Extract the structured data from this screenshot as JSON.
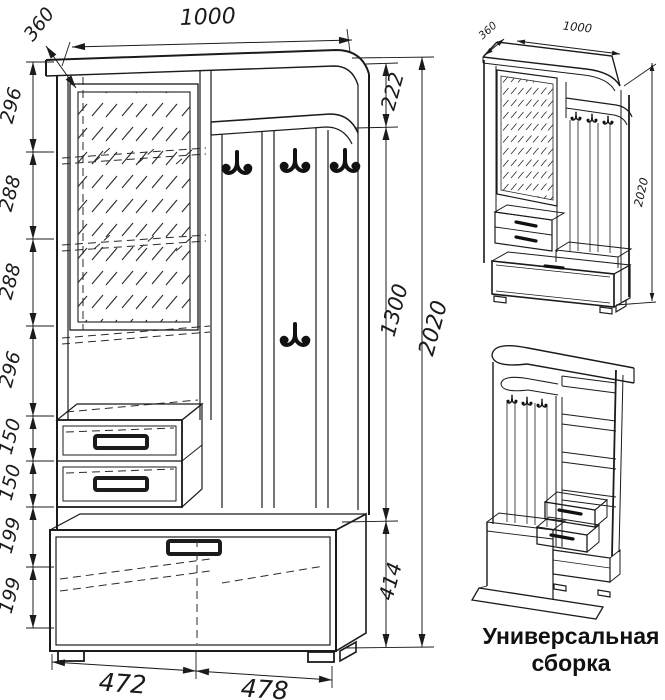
{
  "main_view": {
    "top_width": "1000",
    "depth": "360",
    "left_chain": [
      "296",
      "288",
      "288",
      "296",
      "150",
      "150",
      "199",
      "199"
    ],
    "right_chain": {
      "niche": "222",
      "hooks": "1300",
      "cabinet": "414",
      "total": "2020"
    },
    "bottom_chain": [
      "472",
      "478"
    ]
  },
  "iso_view": {
    "depth": "360",
    "width": "1000",
    "height": "2020"
  },
  "caption": {
    "line1": "Универсальная",
    "line2": "сборка"
  },
  "colors": {
    "ink": "#1b1b1b",
    "background": "#ffffff"
  }
}
